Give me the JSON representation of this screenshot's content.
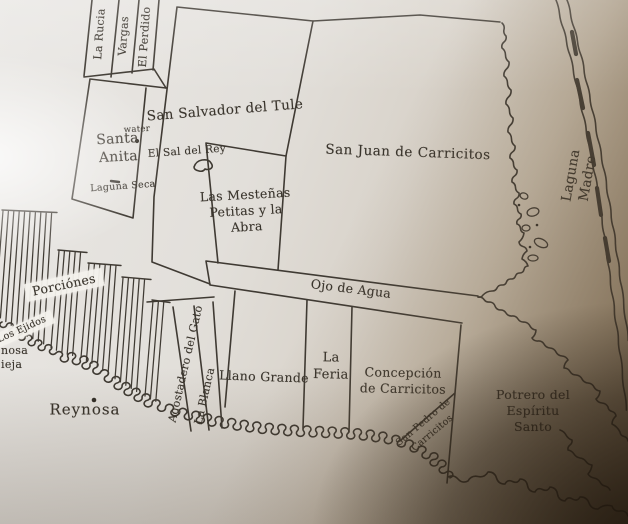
{
  "map": {
    "labels": {
      "la_rucia": "La Rucia",
      "vargas": "Vargas",
      "el_perdido": "El Perdido",
      "san_salvador_del_tule": "San Salvador del Tule",
      "santa_anita": "Santa\nAnita",
      "water": "water",
      "el_sal_del_rey": "El Sal del Rey",
      "laguna_seca": "Laguna Seca",
      "las_mestenas": "Las Mesteñas\nPetitas y la\nAbra",
      "san_juan_de_carricitos": "San Juan de Carricitos",
      "laguna_madre": "Laguna Madre",
      "ojo_de_agua": "Ojo de Agua",
      "porciones": "Porciónes",
      "los_ejidos": "Los Ejidos",
      "reynosa": "Reynosa",
      "reynosa_vieja_fragment": "nosa\nieja",
      "agostadero_del_gato": "Agostadero del Gato",
      "la_blanca": "La Blanca",
      "llano_grande": "Llano Grande",
      "la_feria": "La\nFeria",
      "concepcion_de_carricitos": "Concepción\nde Carricitos",
      "san_pedro_de_carricitos": "San Pedro de\nCarricitos",
      "potrero_del_espiritu_santo": "Potrero del\nEspíritu Santo"
    },
    "colors": {
      "ink": "#3f3a33",
      "paper_light": "#eae8e5",
      "paper_shadow": "#4a3a26",
      "label_band": "#f3f1ec"
    }
  }
}
